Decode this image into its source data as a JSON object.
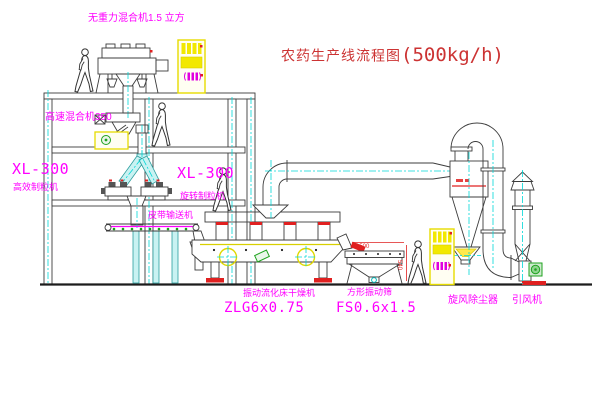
{
  "title": {
    "name": "农药生产线流程图",
    "capacity": "(500kg/h)"
  },
  "labels": {
    "gravity_free_mixer": "无重力混合机1.5 立方",
    "high_speed_mixer": "高速混合机350",
    "granulator_left_model": "XL-300",
    "granulator_left_name": "高效制粒机",
    "granulator_center_model": "XL-300",
    "granulator_center_name": "旋转制粒机",
    "belt_conveyor": "皮带输送机",
    "fluid_bed_dryer_name": "振动流化床干燥机",
    "fluid_bed_dryer_model": "ZLG6x0.75",
    "vibrating_sieve_name": "方形振动筛",
    "vibrating_sieve_model": "FS0.6x1.5",
    "cyclone_dust_collector": "旋风除尘器",
    "induced_draft_fan": "引风机"
  },
  "dimensions": {
    "sieve_length": "1500",
    "sieve_height": "540"
  },
  "colors": {
    "label_magenta": "#ff00ff",
    "title_red": "#cc3333",
    "centerline_cyan": "#00d8d8",
    "equipment_yellow": "#f2e800",
    "accent_red": "#e02020",
    "accent_green": "#1fa31f",
    "line": "#3c3c3c"
  }
}
